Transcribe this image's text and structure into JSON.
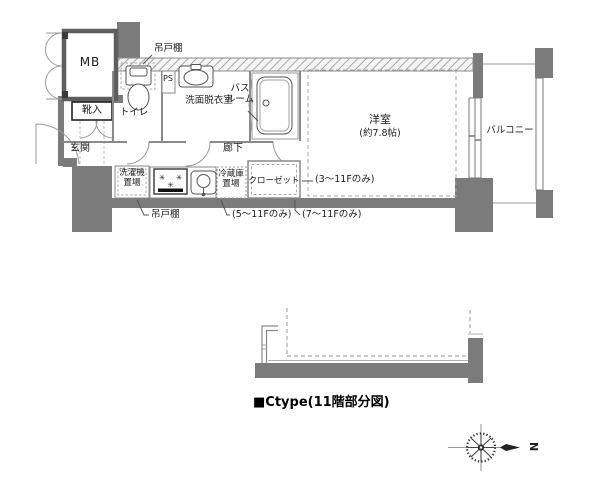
{
  "colors": {
    "wall_fill": "#7b7b7b",
    "thin_line": "#8a8a8a",
    "fixture_line": "#555555",
    "text": "#1c1c1c",
    "background": "#ffffff"
  },
  "plan": {
    "labels": {
      "mb": "MB",
      "shoe_cabinet": "靴入",
      "entrance": "玄関",
      "toilet": "トイレ",
      "pipe_space": "PS",
      "washroom": "洗面脱衣室",
      "bathroom": [
        "バス",
        "ルーム"
      ],
      "corridor": "廊下",
      "western_room": "洋室",
      "western_room_size": "(約7.8帖)",
      "balcony": "バルコニー",
      "laundry": [
        "洗濯機",
        "置場"
      ],
      "fridge": [
        "冷蔵庫",
        "置場"
      ],
      "closet": "クローゼット",
      "hanging_cupboard_top": "吊戸棚",
      "hanging_cupboard_bottom": "吊戸棚",
      "note_floors_3_11": "(3〜11Fのみ)",
      "note_floors_5_11": "(5〜11Fのみ)",
      "note_floors_7_11": "(7〜11Fのみ)"
    },
    "caption": "■Ctype(11階部分図)",
    "compass": {
      "north_label": "N"
    },
    "icons": {
      "burner": "✳"
    }
  }
}
